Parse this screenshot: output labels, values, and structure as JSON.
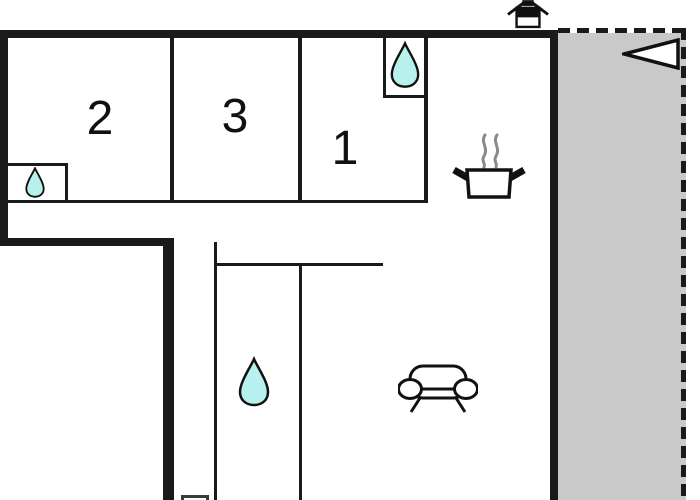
{
  "floorplan": {
    "title": "apartment-floor-plan",
    "rooms": [
      {
        "id": "room-2",
        "label": "2"
      },
      {
        "id": "room-3",
        "label": "3"
      },
      {
        "id": "room-1",
        "label": "1"
      }
    ],
    "icons": [
      {
        "name": "house-icon",
        "meaning": "building/entrance marker above plan"
      },
      {
        "name": "north-arrow-icon",
        "meaning": "orientation arrow pointing left"
      },
      {
        "name": "water-drop-icon-room-1-closet",
        "meaning": "water point in closet of room 1"
      },
      {
        "name": "water-drop-icon-room-2-closet",
        "meaning": "water point in closet of room 2"
      },
      {
        "name": "water-drop-icon-bathroom",
        "meaning": "water point in bathroom"
      },
      {
        "name": "cooking-pot-icon",
        "meaning": "kitchen / stove area"
      },
      {
        "name": "sofa-icon",
        "meaning": "living room seating"
      }
    ],
    "areas": {
      "terrace": "shaded gray outdoor area with dashed boundary on right side"
    },
    "colors": {
      "wall": "#1a1a1a",
      "water": "#b7f1ee",
      "terrace": "#c9c9c9",
      "steam": "#8a8a8a",
      "background": "#ffffff"
    }
  }
}
